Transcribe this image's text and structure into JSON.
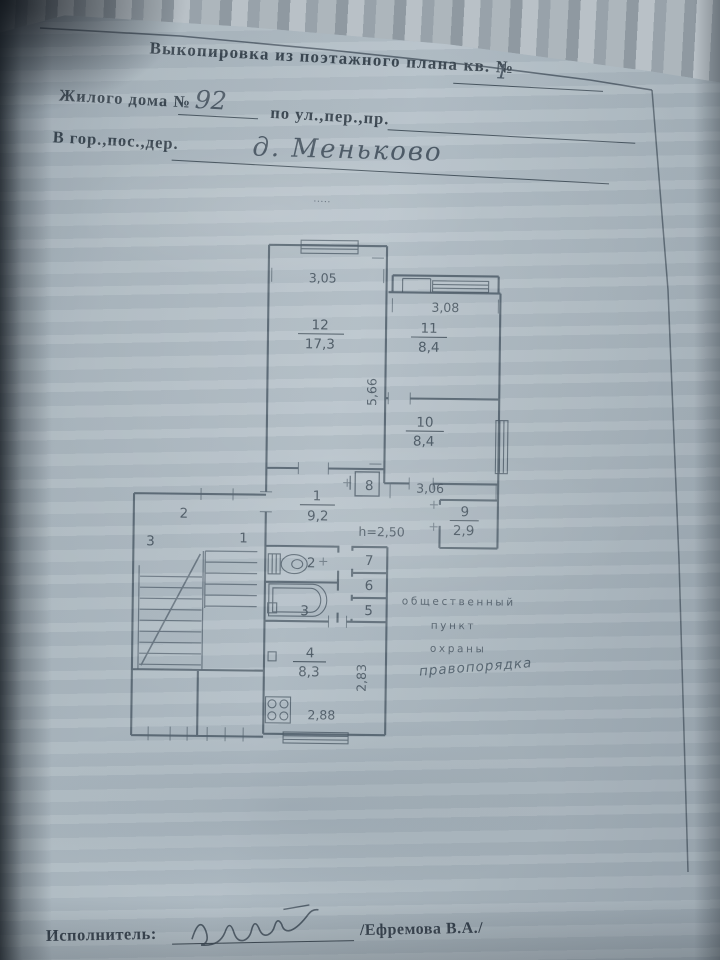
{
  "header": {
    "title": "Выкопировка из поэтажного плана кв. №",
    "apt_number": "1",
    "line2_label": "Жилого дома №",
    "house_number": "92",
    "line2_suffix": "по ул.,пер.,пр.",
    "line3_label": "В гор.,пос.,дер.",
    "settlement": "д. Меньково",
    "dots": "....."
  },
  "plan": {
    "rooms": [
      {
        "number": "12",
        "area": "17,3"
      },
      {
        "number": "11",
        "area": "8,4"
      },
      {
        "number": "10",
        "area": "8,4"
      },
      {
        "number": "1",
        "area": "9,2"
      },
      {
        "number": "9",
        "area": "2,9"
      },
      {
        "number": "4",
        "area": "8,3"
      }
    ],
    "labels": {
      "closet8": "8",
      "closet7": "7",
      "closet6": "6",
      "closet5": "5",
      "wc": "2",
      "bath": "3",
      "stair_left": "3",
      "stair_mid": "2",
      "stair_right": "1"
    },
    "dims": {
      "room12_width": "3,05",
      "room11_width": "3,08",
      "room12_depth": "5,66",
      "corridor_width": "3,06",
      "kitchen_width": "2,88",
      "kitchen_depth": "2,83",
      "ceiling_height": "h=2,50"
    },
    "note": {
      "line1": "общественный",
      "line2": "пункт",
      "line3": "охраны",
      "line4": "правопорядка"
    }
  },
  "footer": {
    "executor_label": "Исполнитель:",
    "executor_name": "/Ефремова В.А./"
  },
  "colors": {
    "paper": "#aeb9c1",
    "ink": "#3a4754",
    "pencil": "#4e5b68",
    "background": "#2b343c"
  }
}
